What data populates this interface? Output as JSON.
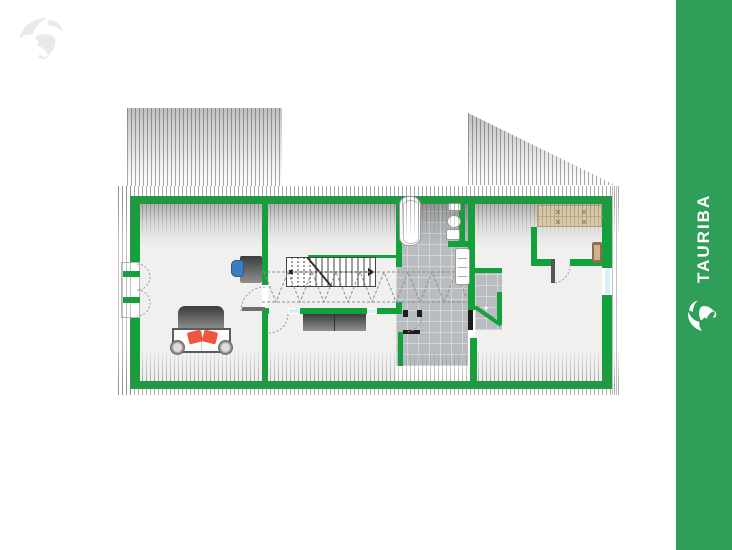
{
  "brand": {
    "name": "TAURIBA",
    "sidebar_logo": "bull-icon",
    "watermark_logo": "bull-icon"
  },
  "colors": {
    "sidebar-green": "#2F9E58",
    "wall-green": "#12A13A",
    "floor": "#F0F0EE",
    "tile": "#B8BCBE",
    "glass": "#D8F0F8",
    "pillow-red": "#F0553F",
    "chair-blue": "#3B7EC0",
    "wardrobe-tan": "#D8C7A4",
    "furniture-dark": "#4A4A4A",
    "watermark-gray": "#E9E9E9"
  },
  "floorplan": {
    "type": "attic-floor-plan",
    "hatch_style": "vertical-stripes-roof-slope",
    "elements": [
      "double-bed",
      "pillows",
      "desk",
      "office-chair",
      "casement-window",
      "staircase",
      "direction-arrow",
      "headroom-dashed-line",
      "sideboard",
      "bathtub",
      "toilet",
      "radiator",
      "tiled-bathroom",
      "shower-vestibule",
      "wardrobe",
      "dresser",
      "door-swing-arcs",
      "roof-dormer",
      "gable-roof-triangle"
    ]
  }
}
